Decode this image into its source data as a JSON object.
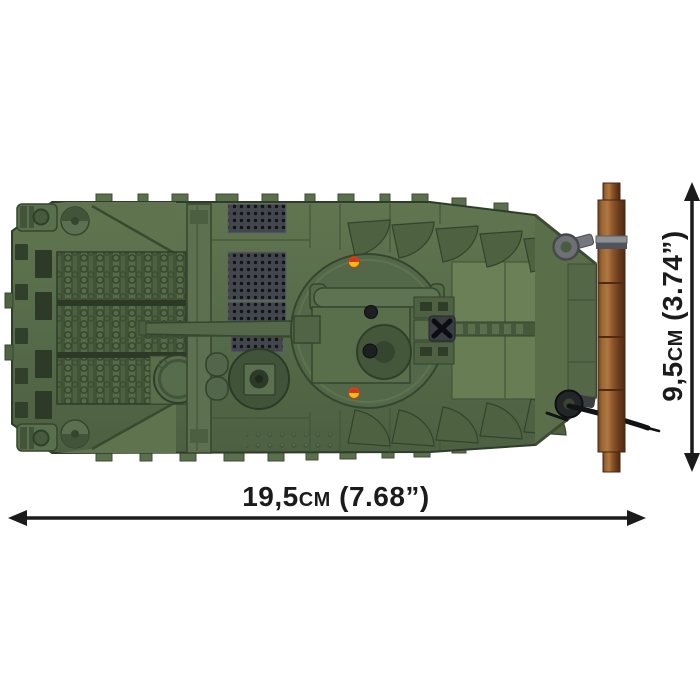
{
  "dimensions": {
    "width_label": "19,5cm (7.68”)",
    "height_label": "9,5cm (3.74”)"
  },
  "colors": {
    "background": "#ffffff",
    "annotation_ink": "#1b1b1b",
    "hull_green": "#566b49",
    "hull_green_light": "#6b8057",
    "hull_green_dark": "#42543a",
    "deck_slat_green": "#425436",
    "grille_dark": "#43464d",
    "grille_hole": "#121316",
    "log_brown": "#8b552a",
    "clamp_gray": "#8d9196",
    "cable_black": "#121315",
    "marking_yellow": "#f2bd13",
    "marking_red": "#d5371d"
  }
}
